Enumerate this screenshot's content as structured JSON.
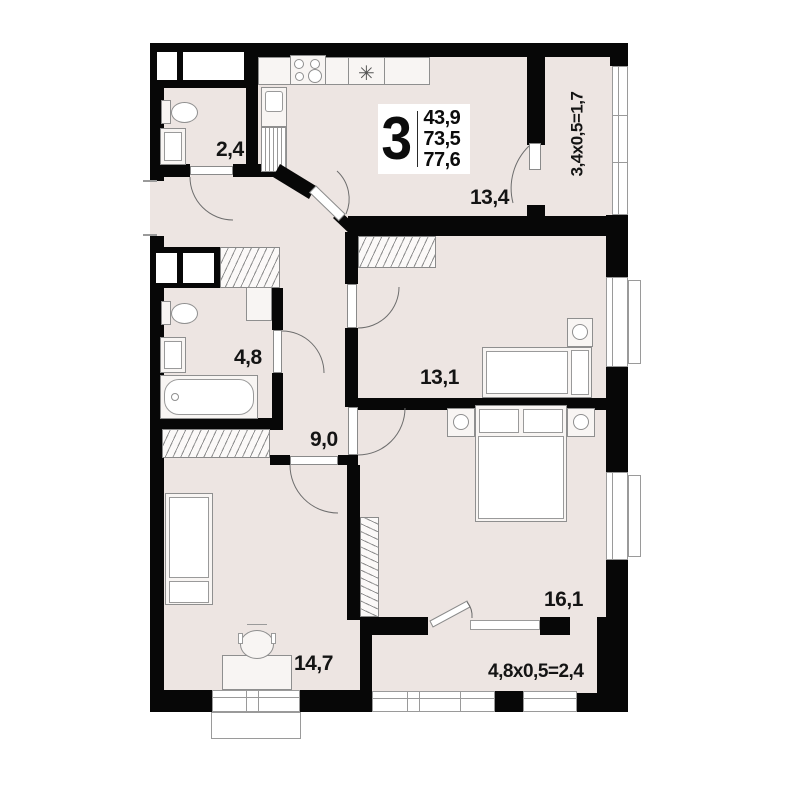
{
  "plan": {
    "title": "3-room apartment floor plan",
    "apartment_info": {
      "rooms_count": "3",
      "living_area": "43,9",
      "apartment_area": "73,5",
      "total_area": "77,6"
    },
    "labels": {
      "wc": "2,4",
      "kitchen_living": "13,4",
      "loggia": "3,4x0,5=1,7",
      "bathroom": "4,8",
      "hallway": "9,0",
      "bedroom1": "13,1",
      "bedroom2": "14,7",
      "bedroom3": "16,1",
      "balcony": "4,8x0,5=2,4"
    },
    "icons": {
      "sink_glyph": "✳"
    },
    "colors": {
      "floor": "#EDE5E2",
      "wall": "#070707",
      "fixture_fill": "#F8F5F3",
      "fixture_border": "#8f8f8f",
      "text": "#141414"
    }
  }
}
